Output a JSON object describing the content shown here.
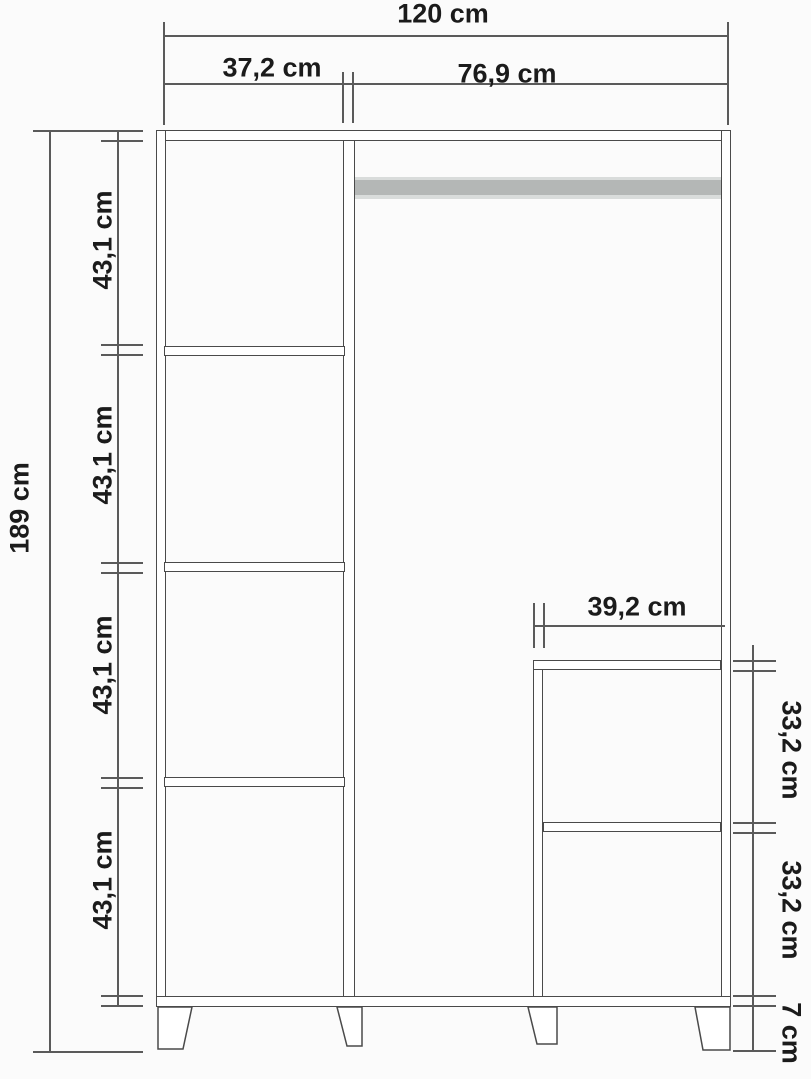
{
  "diagram_type": "furniture-dimension-drawing",
  "subject": "three-section wardrobe front elevation with dimensions",
  "unit": "cm",
  "labels": {
    "total_width": "120 cm",
    "left_column_width": "37,2 cm",
    "right_opening_width": "76,9 cm",
    "total_height": "189 cm",
    "left_shelf_spacings": [
      "43,1 cm",
      "43,1 cm",
      "43,1 cm",
      "43,1 cm"
    ],
    "compartment_width": "39,2 cm",
    "compartment_spacings": [
      "33,2 cm",
      "33,2 cm"
    ],
    "foot_height": "7 cm"
  },
  "colors": {
    "background": "#fbfbfb",
    "structure_line": "#4a4a4a",
    "dimension_line": "#5a5a5a",
    "label_text": "#1b1b1b",
    "hanging_rod_fill": "#b4b7b6",
    "hanging_rod_edge": "#d9dcdb"
  }
}
